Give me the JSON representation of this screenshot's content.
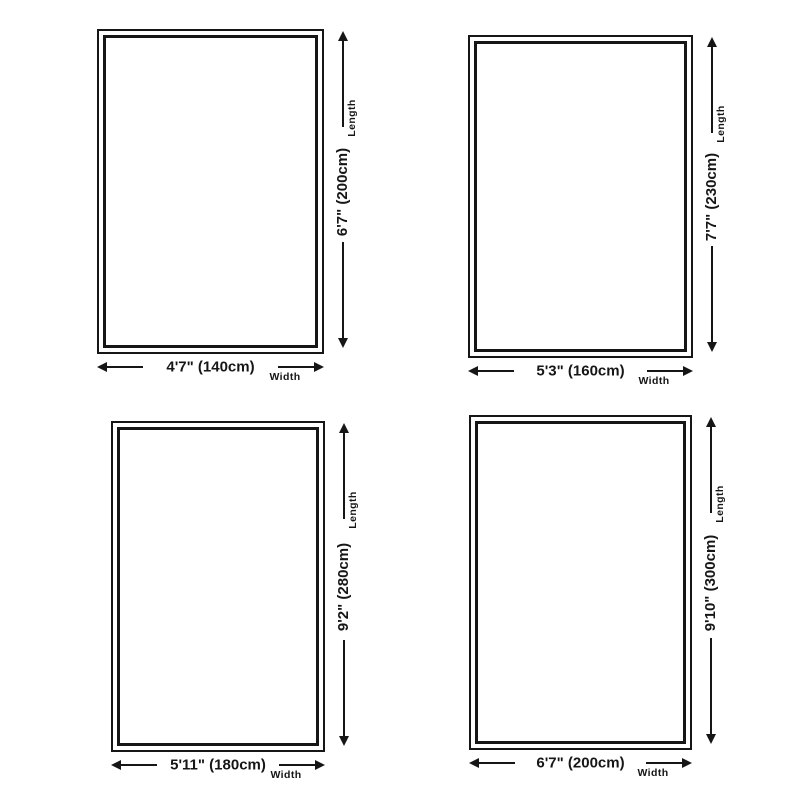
{
  "page": {
    "background_color": "#ffffff",
    "line_color": "#161616"
  },
  "axis_labels": {
    "length": "Length",
    "width": "Width"
  },
  "panels": [
    {
      "name": "size-140x200",
      "width_text": "4'7\" (140cm)",
      "length_text": "6'7\" (200cm)"
    },
    {
      "name": "size-160x230",
      "width_text": "5'3\" (160cm)",
      "length_text": "7'7\" (230cm)"
    },
    {
      "name": "size-180x280",
      "width_text": "5'11\" (180cm)",
      "length_text": "9'2\" (280cm)"
    },
    {
      "name": "size-200x300",
      "width_text": "6'7\" (200cm)",
      "length_text": "9'10\" (300cm)"
    }
  ]
}
